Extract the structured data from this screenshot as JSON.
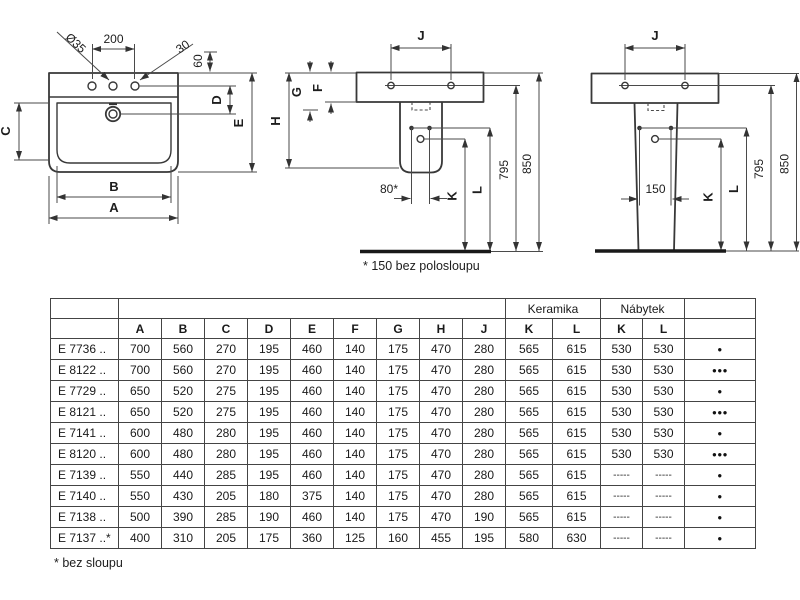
{
  "drawings": {
    "front": {
      "labels": {
        "a": "A",
        "b": "B",
        "c": "C",
        "d": "D",
        "e": "E",
        "hole_diameter": "Ø35",
        "hole_spacing": "200",
        "offset_30": "30",
        "offset_60": "60"
      }
    },
    "semi": {
      "labels": {
        "j": "J",
        "g": "G",
        "f": "F",
        "h": "H",
        "k": "K",
        "l": "L",
        "spacing_80": "80*",
        "h795": "795",
        "h850": "850"
      },
      "note": "* 150 bez polosloupu"
    },
    "pedestal": {
      "labels": {
        "j": "J",
        "k": "K",
        "l": "L",
        "spacing_150": "150",
        "h795": "795",
        "h850": "850"
      }
    }
  },
  "table": {
    "group_headers": [
      {
        "label": "",
        "span": 1
      },
      {
        "label": "",
        "span": 9
      },
      {
        "label": "Keramika",
        "span": 2
      },
      {
        "label": "Nábytek",
        "span": 2
      },
      {
        "label": "",
        "span": 1
      }
    ],
    "columns": [
      "A",
      "B",
      "C",
      "D",
      "E",
      "F",
      "G",
      "H",
      "J",
      "K",
      "L",
      "K",
      "L"
    ],
    "rows": [
      {
        "model": "E 7736 ..",
        "values": [
          700,
          560,
          270,
          195,
          460,
          140,
          175,
          470,
          280,
          565,
          615,
          530,
          530
        ],
        "dots": "●"
      },
      {
        "model": "E 8122 ..",
        "values": [
          700,
          560,
          270,
          195,
          460,
          140,
          175,
          470,
          280,
          565,
          615,
          530,
          530
        ],
        "dots": "●●●"
      },
      {
        "model": "E 7729 ..",
        "values": [
          650,
          520,
          275,
          195,
          460,
          140,
          175,
          470,
          280,
          565,
          615,
          530,
          530
        ],
        "dots": "●"
      },
      {
        "model": "E 8121 ..",
        "values": [
          650,
          520,
          275,
          195,
          460,
          140,
          175,
          470,
          280,
          565,
          615,
          530,
          530
        ],
        "dots": "●●●"
      },
      {
        "model": "E 7141 ..",
        "values": [
          600,
          480,
          280,
          195,
          460,
          140,
          175,
          470,
          280,
          565,
          615,
          530,
          530
        ],
        "dots": "●"
      },
      {
        "model": "E 8120 ..",
        "values": [
          600,
          480,
          280,
          195,
          460,
          140,
          175,
          470,
          280,
          565,
          615,
          530,
          530
        ],
        "dots": "●●●"
      },
      {
        "model": "E 7139 ..",
        "values": [
          550,
          440,
          285,
          195,
          460,
          140,
          175,
          470,
          280,
          565,
          615,
          "-----",
          "-----"
        ],
        "dots": "●"
      },
      {
        "model": "E 7140 ..",
        "values": [
          550,
          430,
          205,
          180,
          375,
          140,
          175,
          470,
          280,
          565,
          615,
          "-----",
          "-----"
        ],
        "dots": "●"
      },
      {
        "model": "E 7138 ..",
        "values": [
          500,
          390,
          285,
          190,
          460,
          140,
          175,
          470,
          190,
          565,
          615,
          "-----",
          "-----"
        ],
        "dots": "●"
      },
      {
        "model": "E 7137 ..*",
        "values": [
          400,
          310,
          205,
          175,
          360,
          125,
          160,
          455,
          195,
          580,
          630,
          "-----",
          "-----"
        ],
        "dots": "●"
      }
    ],
    "footnote": "* bez sloupu"
  }
}
